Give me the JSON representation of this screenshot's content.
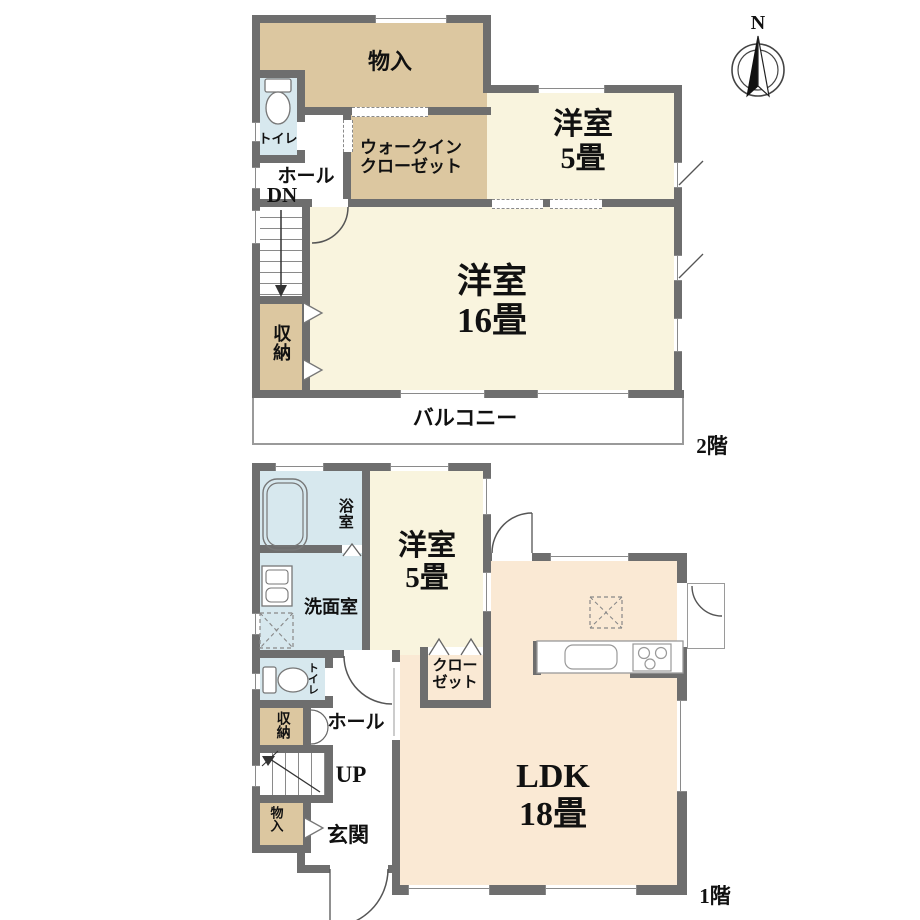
{
  "compass": {
    "north_label": "N"
  },
  "floor2": {
    "floor_label": "2階",
    "labels": {
      "storage_top": "物入",
      "toilet": "トイレ",
      "hall": "ホール",
      "stairs_direction": "DN",
      "wic_line1": "ウォークイン",
      "wic_line2": "クローゼット",
      "room5_line1": "洋室",
      "room5_line2": "5畳",
      "room16_line1": "洋室",
      "room16_line2": "16畳",
      "closet_left": "収納",
      "balcony": "バルコニー"
    }
  },
  "floor1": {
    "floor_label": "1階",
    "labels": {
      "bath": "浴室",
      "washroom": "洗面室",
      "room5_line1": "洋室",
      "room5_line2": "5畳",
      "closet_line1": "クロー",
      "closet_line2": "ゼット",
      "toilet": "トイレ",
      "storage_mid": "収納",
      "hall": "ホール",
      "stairs_direction": "UP",
      "storage_low": "物入",
      "entrance": "玄関",
      "ldk_line1": "LDK",
      "ldk_line2": "18畳"
    }
  },
  "colors": {
    "wall": "#6e6e6e",
    "room_cream": "#f9f4de",
    "room_tan": "#dcc7a0",
    "room_peach": "#fae9d4",
    "room_blue": "#d7e8ee",
    "line": "#555555",
    "text": "#111111"
  }
}
